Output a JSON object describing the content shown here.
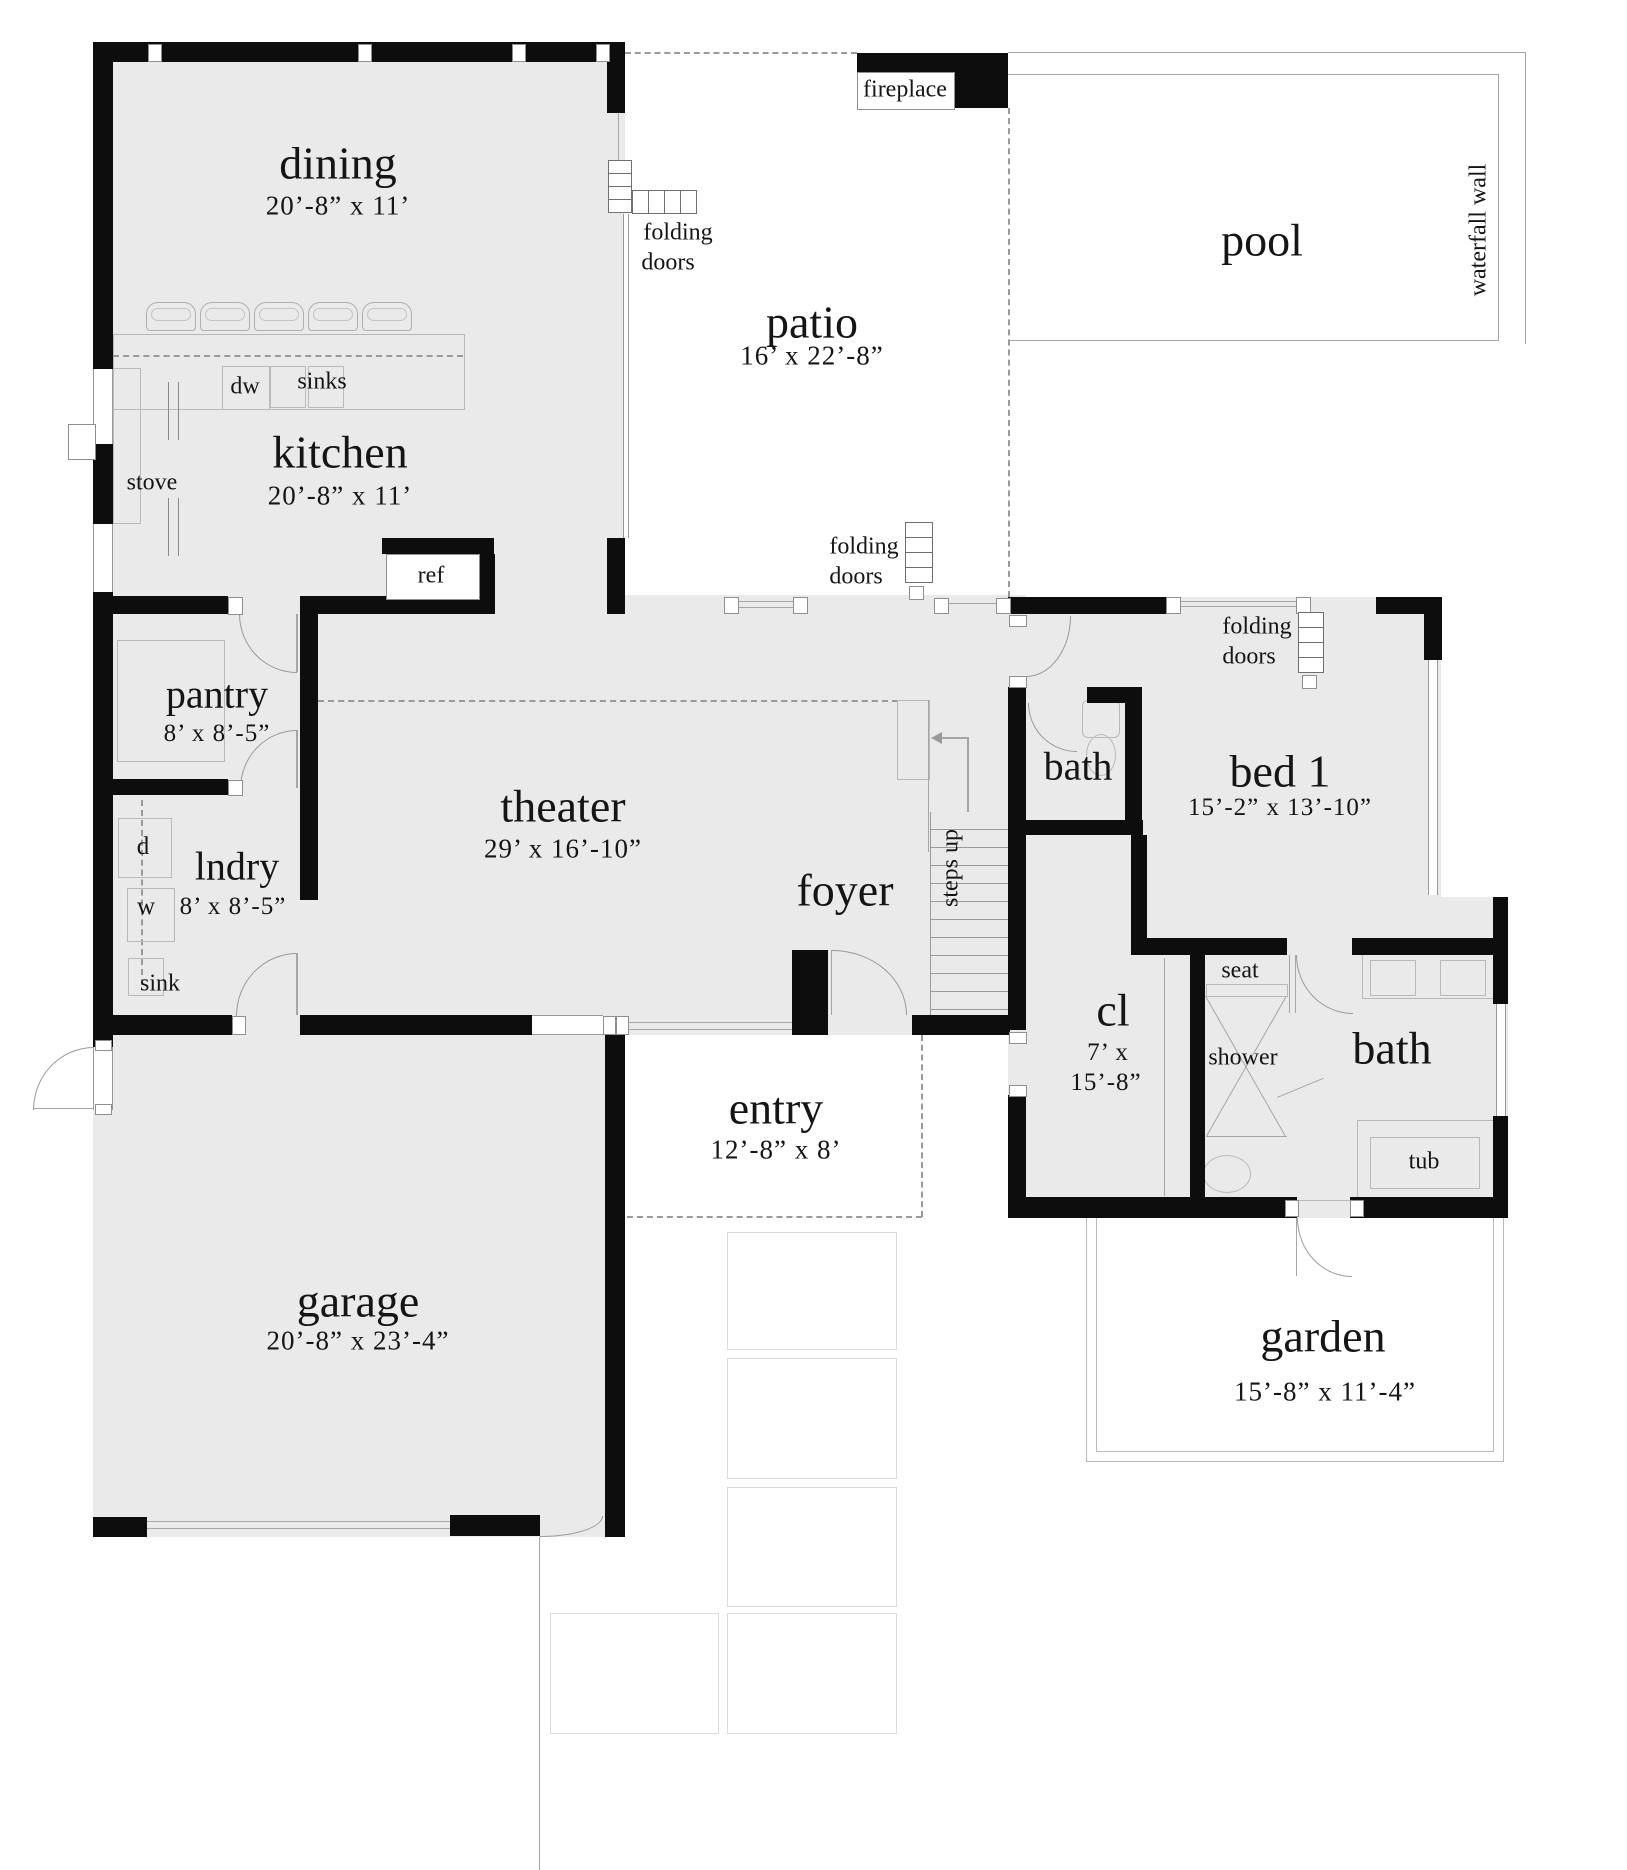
{
  "rooms": {
    "dining": {
      "name": "dining",
      "dims": "20’-8” x 11’"
    },
    "kitchen": {
      "name": "kitchen",
      "dims": "20’-8” x 11’"
    },
    "patio": {
      "name": "patio",
      "dims": "16’ x 22’-8”"
    },
    "pool": {
      "name": "pool"
    },
    "pantry": {
      "name": "pantry",
      "dims": "8’ x 8’-5”"
    },
    "laundry": {
      "name": "lndry",
      "dims": "8’ x 8’-5”"
    },
    "theater": {
      "name": "theater",
      "dims": "29’ x 16’-10”"
    },
    "foyer": {
      "name": "foyer"
    },
    "entry": {
      "name": "entry",
      "dims": "12’-8” x 8’"
    },
    "garage": {
      "name": "garage",
      "dims": "20’-8” x 23’-4”"
    },
    "bed1": {
      "name": "bed 1",
      "dims": "15’-2” x 13’-10”"
    },
    "bath_upper": {
      "name": "bath"
    },
    "bath_main": {
      "name": "bath"
    },
    "closet": {
      "name": "cl",
      "dims_line1": "7’ x",
      "dims_line2": "15’-8”"
    },
    "garden": {
      "name": "garden",
      "dims": "15’-8” x 11’-4”"
    }
  },
  "labels": {
    "fireplace": "fireplace",
    "folding": "folding",
    "doors": "doors",
    "waterfall_wall": "waterfall wall",
    "steps_up": "steps up",
    "dw": "dw",
    "sinks": "sinks",
    "stove": "stove",
    "ref": "ref",
    "d": "d",
    "w": "w",
    "sink": "sink",
    "seat": "seat",
    "shower": "shower",
    "tub": "tub"
  },
  "colors": {
    "wall": "#0d0d0d",
    "floor": "#ebeaea",
    "line": "#9a9a9a",
    "background": "#ffffff"
  }
}
